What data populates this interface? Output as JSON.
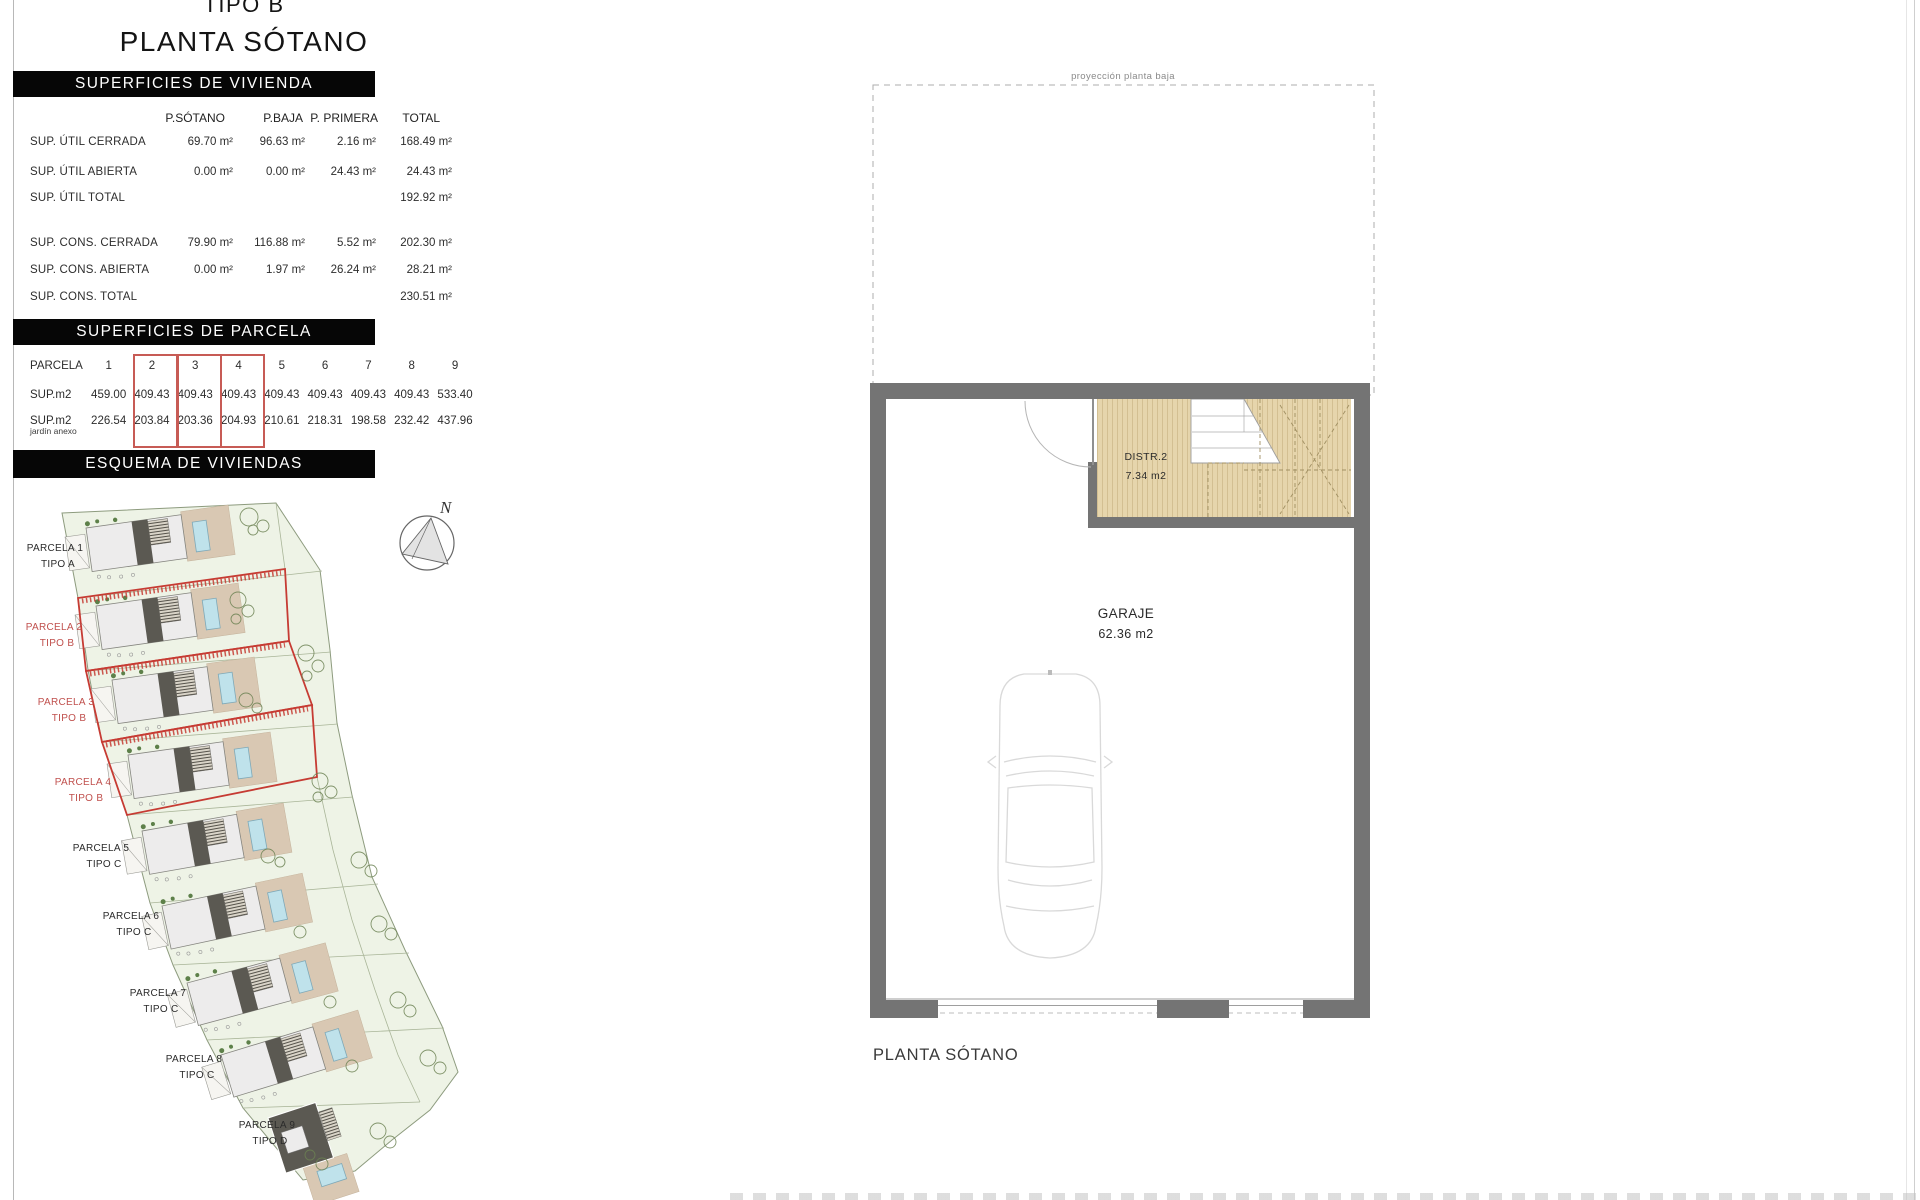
{
  "colors": {
    "header_bar_bg": "#060606",
    "header_bar_text": "#ffffff",
    "highlight_red": "#c63b33",
    "label_red": "#c0504d",
    "text_dark": "#2f2f2f",
    "wall_gray": "#747474",
    "wood_floor_tan": "#e6d5ac",
    "pool_blue": "#bfe2eb",
    "plot_green": "#eef3e6",
    "driveway_tan": "#d9c8b3"
  },
  "titles": {
    "line1": "TIPO B",
    "line2": "PLANTA SÓTANO"
  },
  "viviendas": {
    "header": "SUPERFICIES DE VIVIENDA",
    "columns": [
      "P.SÓTANO",
      "P.BAJA",
      "P. PRIMERA",
      "TOTAL"
    ],
    "rows": [
      {
        "label": "SUP. ÚTIL CERRADA",
        "c1": "69.70 m²",
        "c2": "96.63 m²",
        "c3": "2.16 m²",
        "c4": "168.49 m²"
      },
      {
        "label": "SUP. ÚTIL ABIERTA",
        "c1": "0.00 m²",
        "c2": "0.00 m²",
        "c3": "24.43 m²",
        "c4": "24.43 m²"
      },
      {
        "label": "SUP. ÚTIL TOTAL",
        "c1": "",
        "c2": "",
        "c3": "",
        "c4": "192.92 m²"
      },
      {
        "label": "SUP. CONS.  CERRADA",
        "c1": "79.90 m²",
        "c2": "116.88 m²",
        "c3": "5.52 m²",
        "c4": "202.30 m²"
      },
      {
        "label": "SUP. CONS.  ABIERTA",
        "c1": "0.00 m²",
        "c2": "1.97 m²",
        "c3": "26.24 m²",
        "c4": "28.21 m²"
      },
      {
        "label": "SUP. CONS.  TOTAL",
        "c1": "",
        "c2": "",
        "c3": "",
        "c4": "230.51 m²"
      }
    ]
  },
  "parcelas": {
    "header": "SUPERFICIES DE PARCELA",
    "row_label": "PARCELA",
    "numbers": [
      "1",
      "2",
      "3",
      "4",
      "5",
      "6",
      "7",
      "8",
      "9"
    ],
    "sup_label": "SUP.m2",
    "sup_values": [
      "459.00",
      "409.43",
      "409.43",
      "409.43",
      "409.43",
      "409.43",
      "409.43",
      "409.43",
      "533.40"
    ],
    "jardin_label": "SUP.m2",
    "jardin_sublabel": "jardín anexo",
    "jardin_values": [
      "226.54",
      "203.84",
      "203.36",
      "204.93",
      "210.61",
      "218.31",
      "198.58",
      "232.42",
      "437.96"
    ],
    "highlighted_columns": [
      "2",
      "3",
      "4"
    ]
  },
  "esquema": {
    "header": "ESQUEMA DE VIVIENDAS",
    "north": "N",
    "parcels": [
      {
        "line1": "PARCELA 1",
        "line2": "TIPO A"
      },
      {
        "line1": "PARCELA 2",
        "line2": "TIPO B"
      },
      {
        "line1": "PARCELA 3",
        "line2": "TIPO B"
      },
      {
        "line1": "PARCELA 4",
        "line2": "TIPO B"
      },
      {
        "line1": "PARCELA 5",
        "line2": "TIPO C"
      },
      {
        "line1": "PARCELA 6",
        "line2": "TIPO C"
      },
      {
        "line1": "PARCELA 7",
        "line2": "TIPO C"
      },
      {
        "line1": "PARCELA 8",
        "line2": "TIPO C"
      },
      {
        "line1": "PARCELA 9",
        "line2": "TIPO D"
      }
    ]
  },
  "floorplan": {
    "projection_label": "proyección planta baja",
    "rooms": [
      {
        "name": "DISTR.2",
        "area": "7.34 m2"
      },
      {
        "name": "GARAJE",
        "area": "62.36 m2"
      }
    ],
    "caption": "PLANTA SÓTANO"
  }
}
